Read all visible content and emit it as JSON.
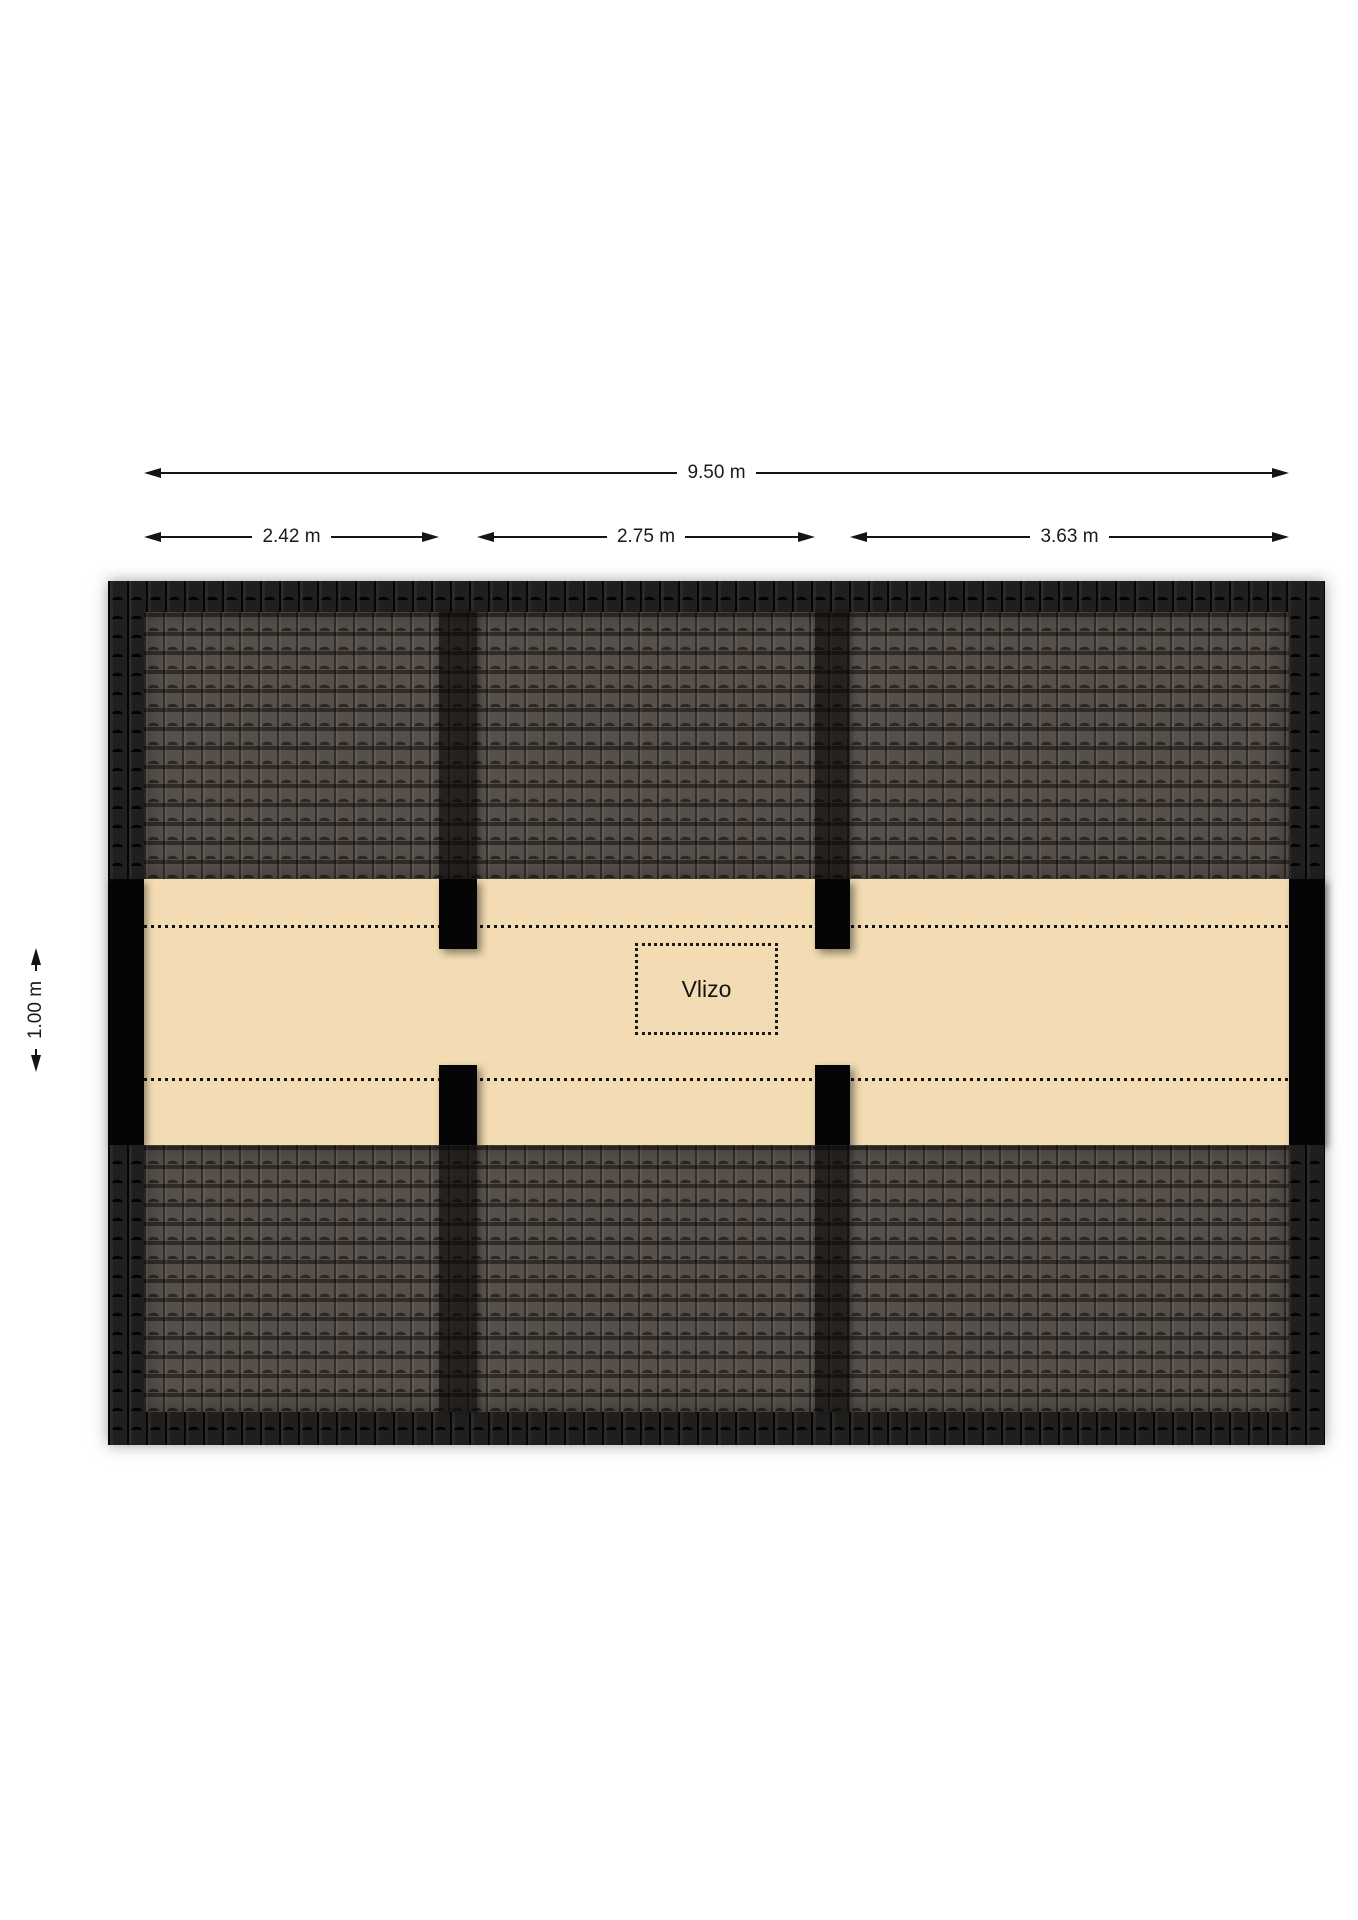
{
  "plan": {
    "room_label": "Vlizo",
    "dimensions": {
      "total": "9.50 m",
      "segment_left": "2.42 m",
      "segment_middle": "2.75 m",
      "segment_right": "3.63 m",
      "corridor_depth": "1.00 m"
    },
    "colors": {
      "floor_beige": "#f3dcb3",
      "roof_tile_brown": "#57504a",
      "roof_edge_dark": "#161514",
      "wall_black": "#050505",
      "dimension_ink": "#141414",
      "page_background": "#ffffff"
    }
  }
}
